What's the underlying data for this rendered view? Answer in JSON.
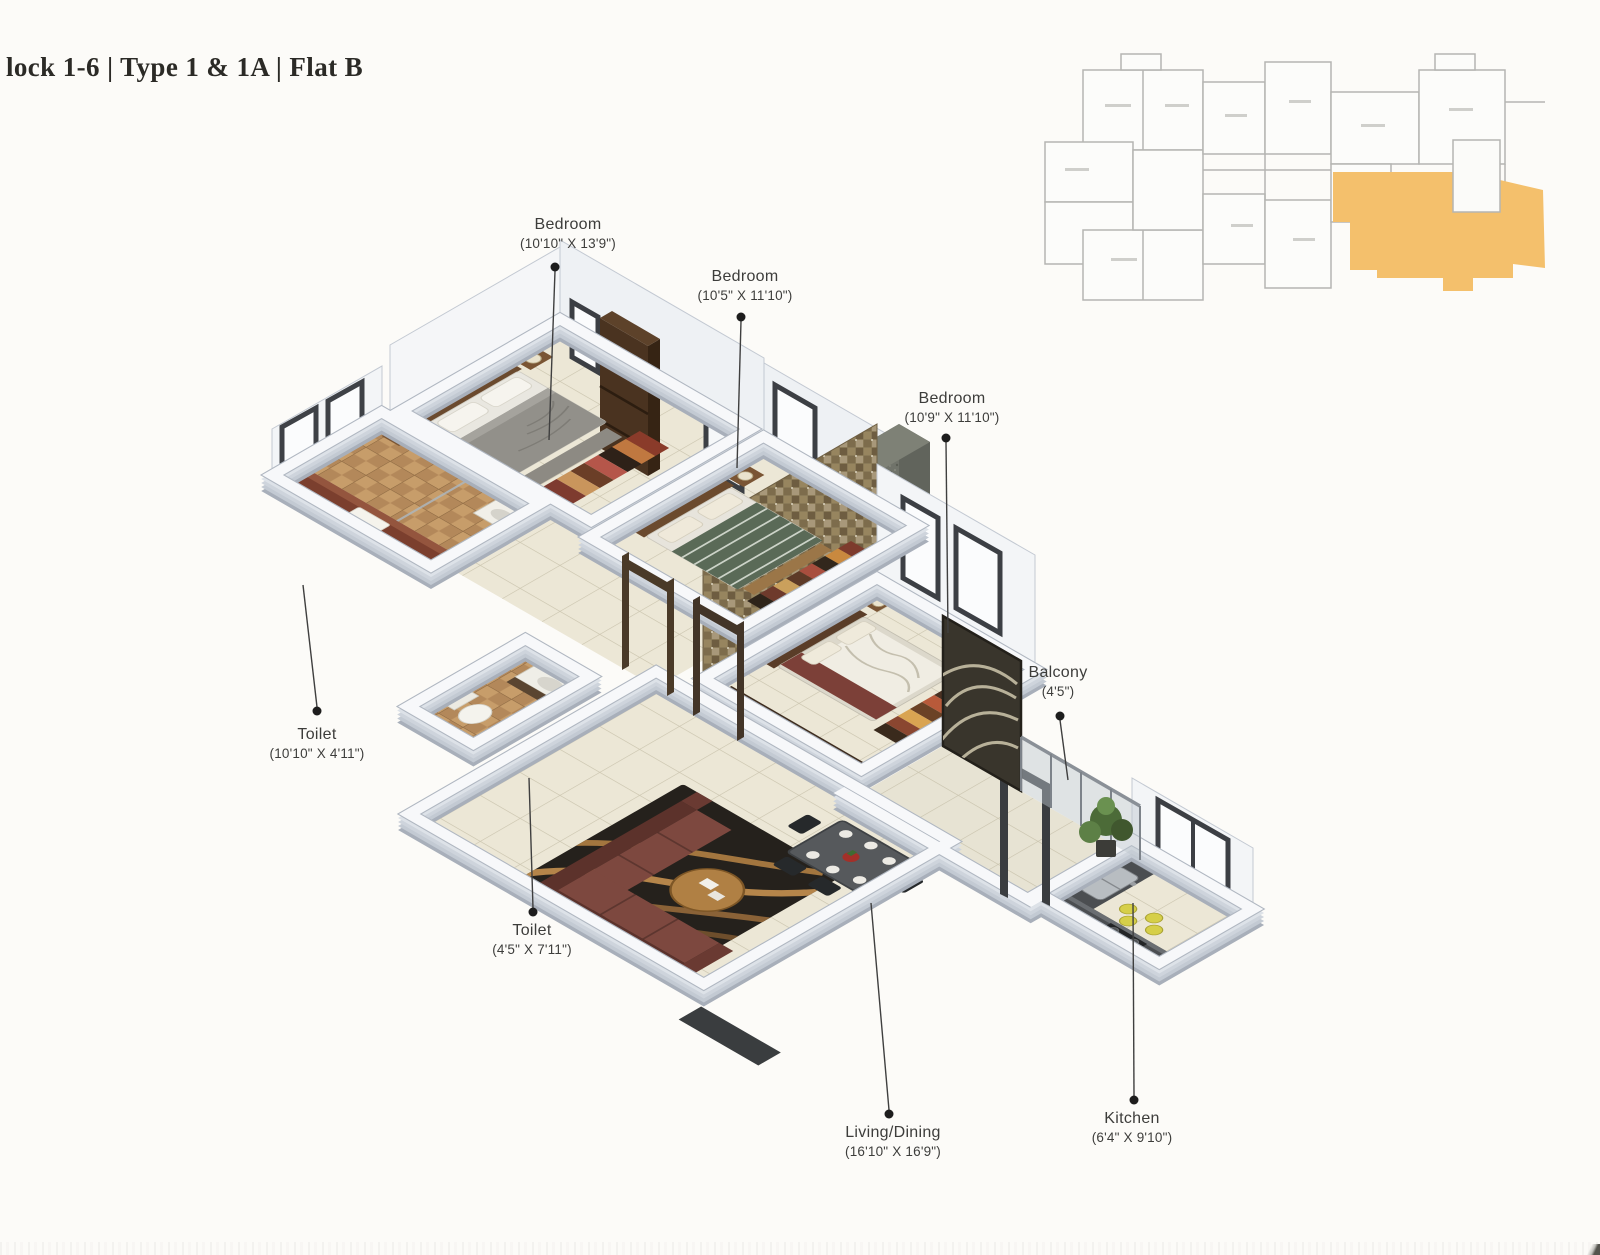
{
  "header": {
    "title": "lock 1-6 | Type 1 & 1A | Flat B"
  },
  "labels": [
    {
      "id": "bedroom-1",
      "name": "Bedroom",
      "dims": "(10'10\" X 13'9\")"
    },
    {
      "id": "bedroom-2",
      "name": "Bedroom",
      "dims": "(10'5\" X 11'10\")"
    },
    {
      "id": "bedroom-3",
      "name": "Bedroom",
      "dims": "(10'9\" X 11'10\")"
    },
    {
      "id": "balcony",
      "name": "Balcony",
      "dims": "(4'5\")"
    },
    {
      "id": "toilet-1",
      "name": "Toilet",
      "dims": "(10'10\" X 4'11\")"
    },
    {
      "id": "toilet-2",
      "name": "Toilet",
      "dims": "(4'5\" X 7'11\")"
    },
    {
      "id": "living-dining",
      "name": "Living/Dining",
      "dims": "(16'10\" X 16'9\")"
    },
    {
      "id": "kitchen",
      "name": "Kitchen",
      "dims": "(6'4\" X 9'10\")"
    }
  ],
  "keyplan": {
    "highlight_color": "#f4c06c"
  },
  "colors": {
    "page_bg": "#fcfbf8",
    "title_text": "#2b2a26",
    "label_text": "#3d3d3b",
    "keyplan_line": "#b5b5b2",
    "keyplan_accent": "#f4c06c",
    "wall_top": "#f7f8fa",
    "wall_side": "#c9cfd8",
    "floor_tile": "#ece7d6",
    "toilet_tile": "#bb8f5e",
    "sofa": "#7d483f",
    "dark_wood": "#4a3320",
    "counter": "#4b4e51"
  }
}
